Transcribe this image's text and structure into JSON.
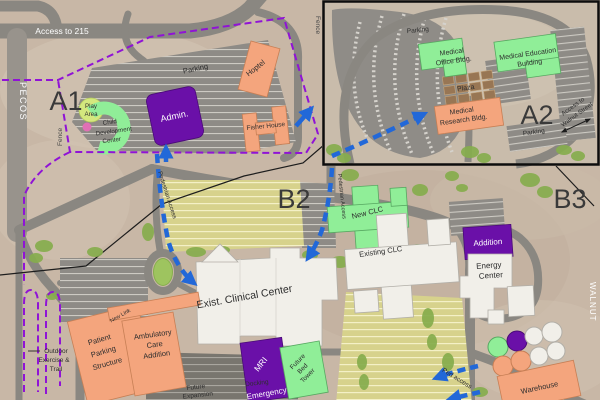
{
  "colors": {
    "building_orange": "#f4a57d",
    "building_green": "#90ee98",
    "building_purple": "#6a10a8",
    "building_white": "#f1efe9",
    "plaza_brown": "#987654",
    "route_blue": "#2268d8",
    "boundary_purple": "#9013d6"
  },
  "zones": {
    "a1": "A1",
    "a2": "A2",
    "b2": "B2",
    "b3": "B3"
  },
  "streets": {
    "pecos": "PECOS",
    "walnut": "WALNUT"
  },
  "access": {
    "i215": "Access to 215",
    "walnut": [
      "Access to",
      "Walnut Street"
    ]
  },
  "labels": {
    "parking": "Parking",
    "fence": "Fence",
    "pedestrian_access": "Pedestrian Access",
    "ped_access": "Ped access",
    "new_link": "New Link",
    "plaza": "Plaza",
    "future_expansion": [
      "Future",
      "Expansion"
    ],
    "docking": "Docking",
    "outdoor_trail": [
      "Outdoor",
      "Exercise &",
      "Trail"
    ],
    "play_area": [
      "Play",
      "Area"
    ]
  },
  "buildings": {
    "admin": "Admin.",
    "cdc": [
      "Child",
      "Development",
      "Center"
    ],
    "hoptel": "Hoptel",
    "fisher_house": "Fisher House",
    "medical_office": [
      "Medical",
      "Office Bldg."
    ],
    "medical_education": [
      "Medical Education",
      "Building"
    ],
    "medical_research": [
      "Medical",
      "Research Bldg."
    ],
    "new_clc": "New CLC",
    "existing_clc": "Existing CLC",
    "exist_clinical_center": "Exist. Clinical Center",
    "patient_parking": [
      "Patient",
      "Parking",
      "Structure"
    ],
    "ambulatory": [
      "Ambulatory",
      "Care",
      "Addition"
    ],
    "mri": "MRI",
    "emergency": "Emergency",
    "future_bed_tower": [
      "Future",
      "Bed",
      "Tower"
    ],
    "addition": "Addition",
    "energy_center": [
      "Energy",
      "Center"
    ],
    "warehouse": "Warehouse"
  }
}
